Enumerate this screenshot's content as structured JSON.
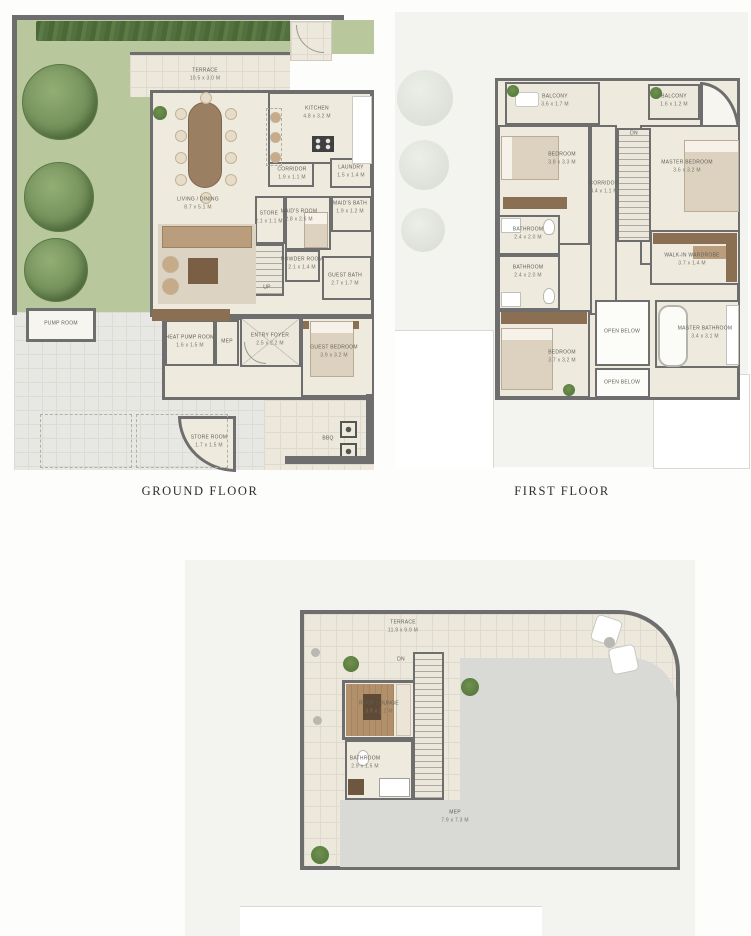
{
  "page": {
    "background": "#fdfdfb"
  },
  "colors": {
    "wall": "#6e6e6e",
    "floor_cream": "#efeade",
    "garden_green": "#b9c79d",
    "hedge_green": "#55713e",
    "tree_green": "#7d9a60",
    "paving_gray": "#e7e7e3",
    "surround_gray": "#f3f3f0",
    "roof_gray": "#d9d9d6",
    "wood_brown": "#8a6f52",
    "label_text": "#5f5f58",
    "title_text": "#2e2e2a"
  },
  "floors": {
    "ground": {
      "title": "GROUND FLOOR",
      "rooms": {
        "terrace": {
          "name": "TERRACE",
          "dims": "10.5 x 3.0 M"
        },
        "living": {
          "name": "LIVING / DINING",
          "dims": "8.7 x 5.1 M"
        },
        "kitchen": {
          "name": "KITCHEN",
          "dims": "4.8 x 3.2 M"
        },
        "corridor": {
          "name": "CORRIDOR",
          "dims": "1.9 x 1.1 M"
        },
        "laundry": {
          "name": "LAUNDRY",
          "dims": "1.5 x 1.4 M"
        },
        "store": {
          "name": "STORE",
          "dims": "2.1 x 1.1 M"
        },
        "maids_room": {
          "name": "MAID'S ROOM",
          "dims": "2.8 x 2.6 M"
        },
        "maids_bath": {
          "name": "MAID'S BATH",
          "dims": "1.9 x 1.2 M"
        },
        "powder_room": {
          "name": "POWDER ROOM",
          "dims": "2.1 x 1.4 M"
        },
        "guest_bath": {
          "name": "GUEST BATH",
          "dims": "2.7 x 1.7 M"
        },
        "stairs": {
          "name": "UP"
        },
        "entry_foyer": {
          "name": "ENTRY FOYER",
          "dims": "2.5 x 2.2 M"
        },
        "guest_bedroom": {
          "name": "GUEST BEDROOM",
          "dims": "3.9 x 3.2 M"
        },
        "heat_pump_room": {
          "name": "HEAT PUMP ROOM",
          "dims": "1.6 x 1.5 M"
        },
        "mep": {
          "name": "MEP"
        },
        "pump_room": {
          "name": "PUMP ROOM"
        },
        "store_room": {
          "name": "STORE ROOM",
          "dims": "1.7 x 1.5 M"
        },
        "bbq": {
          "name": "BBQ"
        }
      }
    },
    "first": {
      "title": "FIRST FLOOR",
      "rooms": {
        "balcony_left": {
          "name": "BALCONY",
          "dims": "3.6 x 1.7 M"
        },
        "balcony_right": {
          "name": "BALCONY",
          "dims": "1.6 x 1.2 M"
        },
        "bedroom_2": {
          "name": "BEDROOM",
          "dims": "3.8 x 3.3 M"
        },
        "master_bedroom": {
          "name": "MASTER BEDROOM",
          "dims": "3.6 x 3.2 M"
        },
        "corridor": {
          "name": "CORRIDOR",
          "dims": "4.4 x 1.1 M"
        },
        "stairs": {
          "name": "DN"
        },
        "bathroom_2": {
          "name": "BATHROOM",
          "dims": "2.4 x 2.0 M"
        },
        "bathroom_3": {
          "name": "BATHROOM",
          "dims": "2.4 x 2.0 M"
        },
        "walk_in_wardrobe": {
          "name": "WALK-IN WARDROBE",
          "dims": "3.7 x 1.4 M"
        },
        "master_bathroom": {
          "name": "MASTER BATHROOM",
          "dims": "3.4 x 3.1 M"
        },
        "bedroom_3": {
          "name": "BEDROOM",
          "dims": "3.7 x 3.2 M"
        },
        "open_below_1": {
          "name": "OPEN BELOW"
        },
        "open_below_2": {
          "name": "OPEN BELOW"
        }
      }
    },
    "roof": {
      "rooms": {
        "terrace": {
          "name": "TERRACE",
          "dims": "11.9 x 9.9 M"
        },
        "roof_lounge": {
          "name": "ROOF LOUNGE",
          "dims": "3.9 x 3.2 M"
        },
        "bathroom": {
          "name": "BATHROOM",
          "dims": "2.9 x 1.5 M"
        },
        "mep": {
          "name": "MEP",
          "dims": "7.9 x 7.3 M"
        },
        "stairs": {
          "name": "DN"
        }
      }
    }
  }
}
